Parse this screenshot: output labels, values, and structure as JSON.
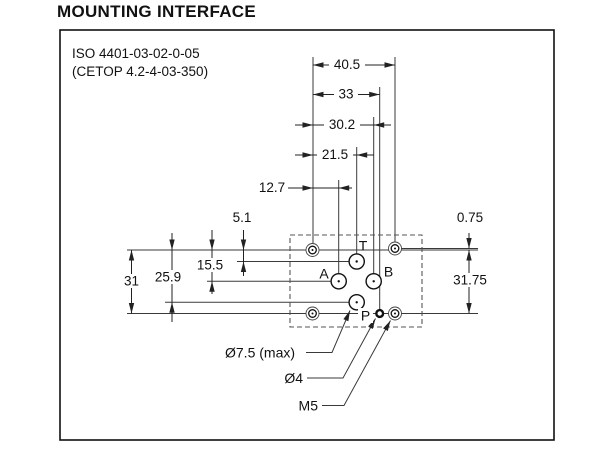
{
  "title": "MOUNTING INTERFACE",
  "standard": {
    "iso": "ISO 4401-03-02-0-05",
    "cetop": "(CETOP 4.2-4-03-350)"
  },
  "dims": {
    "overall_width": "40.5",
    "pin_hole_x": "33",
    "port_b_x": "30.2",
    "ports_tp_x": "21.5",
    "port_a_x": "12.7",
    "port_t_y": "5.1",
    "ports_ab_y": "15.5",
    "port_p_y": "25.9",
    "bolt_left_spacing": "31",
    "bolt_right_offset": "0.75",
    "bolt_right_spacing": "31.75"
  },
  "ports": {
    "t": "T",
    "a": "A",
    "b": "B",
    "p": "P"
  },
  "callouts": {
    "port_max": "Ø7.5 (max)",
    "pin": "Ø4",
    "bolt": "M5"
  },
  "colors": {
    "line": "#2b2b2b",
    "text": "#111111",
    "background": "#ffffff"
  }
}
